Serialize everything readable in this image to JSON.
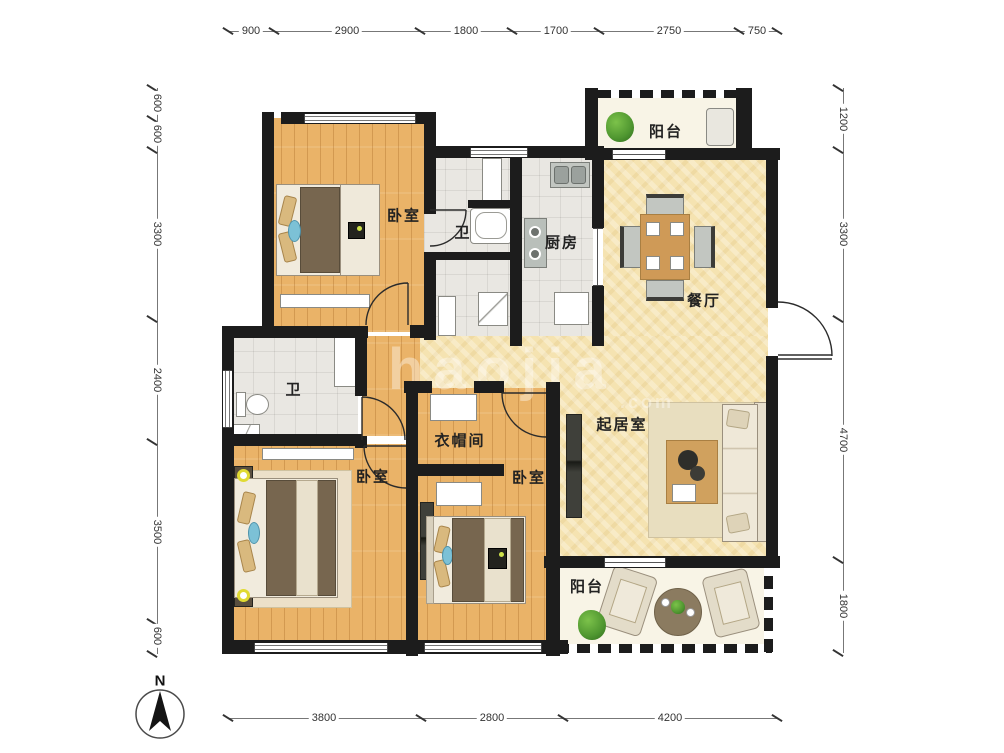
{
  "plan": {
    "rooms": {
      "bedroom_top": "卧室",
      "bath_top": "卫",
      "kitchen": "厨房",
      "balcony_top": "阳台",
      "dining": "餐厅",
      "living": "起居室",
      "bath_mid": "卫",
      "cloakroom": "衣帽间",
      "bedroom_left": "卧室",
      "bedroom_mid": "卧室",
      "balcony_bottom": "阳台"
    },
    "compass_label": "N",
    "watermark": "haojia",
    "watermark_suffix": ".com"
  },
  "dimensions": {
    "top": [
      "900",
      "2900",
      "1800",
      "1700",
      "2750",
      "750"
    ],
    "bottom": [
      "3800",
      "2800",
      "4200"
    ],
    "left": [
      "600",
      "600",
      "3300",
      "2400",
      "3500",
      "600"
    ],
    "right": [
      "1200",
      "3300",
      "4700",
      "1800"
    ]
  },
  "colors": {
    "wall": "#1c1c1c",
    "wood_floor": "#eab368",
    "tile_floor": "#e9e7e2",
    "warm_floor": "#f5e3b1",
    "balcony_floor": "#f8f4e6",
    "blanket": "#77664f",
    "plant": "#4f9630",
    "cushion": "#7cc1d6",
    "dim_text": "#333333"
  }
}
